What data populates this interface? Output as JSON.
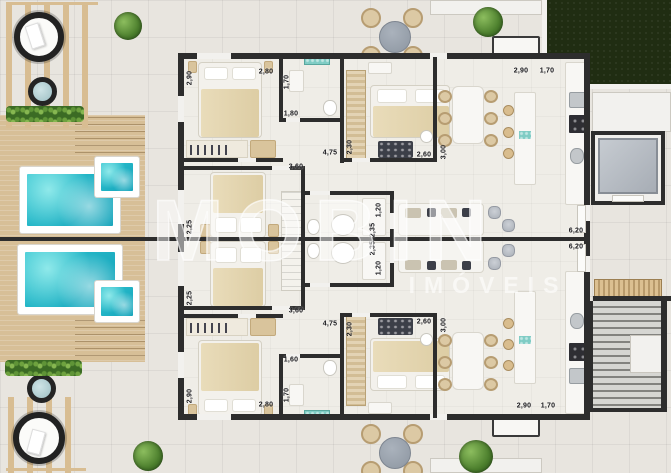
{
  "watermark": {
    "brand": "MOBIN",
    "subtitle": "IMÓVEIS"
  },
  "palette": {
    "outdoor_tile": "#e8e5df",
    "interior_floor": "#efede7",
    "wall": "#2d2d2d",
    "deck_wood": "#d7bf97",
    "pool_water": "#2ec2cf",
    "spa_water": "#9dbfc4",
    "grass": "#202d12",
    "greenery": "#4c7f2d",
    "furniture_white": "#f8f7f4",
    "bed_blanket": "#e5d8b6",
    "metal_gray": "#b6bac2",
    "accent_teal": "#7fccc4"
  },
  "dimension_labels": [
    {
      "value": "2,80",
      "x": 266,
      "y": 72,
      "rot": 0
    },
    {
      "value": "2,90",
      "x": 190,
      "y": 78,
      "rot": 90
    },
    {
      "value": "1,70",
      "x": 287,
      "y": 82,
      "rot": 90
    },
    {
      "value": "1,80",
      "x": 291,
      "y": 114,
      "rot": 0
    },
    {
      "value": "4,75",
      "x": 330,
      "y": 153,
      "rot": 0
    },
    {
      "value": "3,60",
      "x": 296,
      "y": 167,
      "rot": 0
    },
    {
      "value": "2,30",
      "x": 350,
      "y": 147,
      "rot": 90
    },
    {
      "value": "2,60",
      "x": 424,
      "y": 155,
      "rot": 0
    },
    {
      "value": "3,00",
      "x": 444,
      "y": 152,
      "rot": 90
    },
    {
      "value": "2,90",
      "x": 521,
      "y": 71,
      "rot": 0
    },
    {
      "value": "1,70",
      "x": 547,
      "y": 71,
      "rot": 0
    },
    {
      "value": "2,25",
      "x": 190,
      "y": 227,
      "rot": 90
    },
    {
      "value": "2,25",
      "x": 190,
      "y": 298,
      "rot": 90
    },
    {
      "value": "3,60",
      "x": 296,
      "y": 311,
      "rot": 0
    },
    {
      "value": "1,20",
      "x": 379,
      "y": 210,
      "rot": 90
    },
    {
      "value": "2,35",
      "x": 373,
      "y": 230,
      "rot": 90
    },
    {
      "value": "2,35",
      "x": 373,
      "y": 248,
      "rot": 90
    },
    {
      "value": "1,20",
      "x": 379,
      "y": 268,
      "rot": 90
    },
    {
      "value": "6,20",
      "x": 576,
      "y": 231,
      "rot": 0
    },
    {
      "value": "6,20",
      "x": 576,
      "y": 247,
      "rot": 0
    },
    {
      "value": "4,75",
      "x": 330,
      "y": 324,
      "rot": 0
    },
    {
      "value": "1,60",
      "x": 291,
      "y": 360,
      "rot": 0
    },
    {
      "value": "1,70",
      "x": 287,
      "y": 395,
      "rot": 90
    },
    {
      "value": "2,80",
      "x": 266,
      "y": 405,
      "rot": 0
    },
    {
      "value": "2,90",
      "x": 190,
      "y": 396,
      "rot": 90
    },
    {
      "value": "2,30",
      "x": 350,
      "y": 329,
      "rot": 90
    },
    {
      "value": "2,60",
      "x": 424,
      "y": 322,
      "rot": 0
    },
    {
      "value": "3,00",
      "x": 444,
      "y": 325,
      "rot": 90
    },
    {
      "value": "2,90",
      "x": 524,
      "y": 406,
      "rot": 0
    },
    {
      "value": "1,70",
      "x": 548,
      "y": 406,
      "rot": 0
    }
  ]
}
